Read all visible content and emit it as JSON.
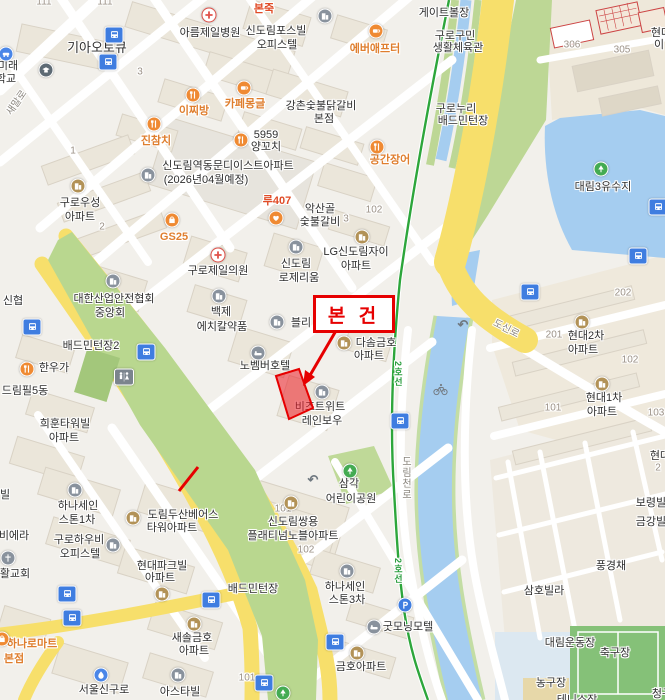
{
  "annotation": {
    "subject_label": "본 건",
    "box": {
      "x": 313,
      "y": 295,
      "w": 76,
      "h": 32,
      "font_size": 19
    },
    "arrow": {
      "x1": 337,
      "y1": 329,
      "x2": 307,
      "y2": 379
    },
    "extra_segment": {
      "x1": 198,
      "y1": 467,
      "x2": 179,
      "y2": 491
    },
    "building_polygon": "276,376 299,369 313,408 289,419",
    "color": "#e60000"
  },
  "colors": {
    "background": "#f2f0eb",
    "road_major_yellow": "#f7df6b",
    "road_white": "#ffffff",
    "water": "#a5cdf0",
    "green_park": "#b9d78f",
    "subway_line2_green": "#2da63b",
    "poi_food_orange": "#ef8a33",
    "poi_apartment_brown": "#b29257",
    "poi_gray": "#89929d",
    "bus_stop_blue": "#3f7de0",
    "annotation_red": "#e60000"
  },
  "map": {
    "labels": [
      {
        "t": "기아오토큐",
        "x": 97,
        "y": 48,
        "s": "place",
        "fs": 13
      },
      {
        "t": "미래",
        "x": 8,
        "y": 66,
        "s": "place"
      },
      {
        "t": "학교",
        "x": 6,
        "y": 79,
        "s": "place"
      },
      {
        "t": "아름제일병원",
        "x": 210,
        "y": 33,
        "s": "place"
      },
      {
        "t": "신도림포스빌",
        "x": 276,
        "y": 31,
        "s": "place"
      },
      {
        "t": "오피스텔",
        "x": 277,
        "y": 45,
        "s": "place"
      },
      {
        "t": "게이트볼장",
        "x": 444,
        "y": 13,
        "s": "place"
      },
      {
        "t": "구로구민",
        "x": 455,
        "y": 36,
        "s": "place"
      },
      {
        "t": "생활체육관",
        "x": 458,
        "y": 48,
        "s": "place"
      },
      {
        "t": "구로누리",
        "x": 456,
        "y": 109,
        "s": "place"
      },
      {
        "t": "배드민턴장",
        "x": 463,
        "y": 121,
        "s": "place"
      },
      {
        "t": "강촌숯불닭갈비",
        "x": 321,
        "y": 106,
        "s": "place"
      },
      {
        "t": "본점",
        "x": 324,
        "y": 119,
        "s": "place"
      },
      {
        "t": "5959",
        "x": 266,
        "y": 135,
        "s": "place"
      },
      {
        "t": "양꼬치",
        "x": 266,
        "y": 147,
        "s": "place"
      },
      {
        "t": "신도림역동문디이스트아파트",
        "x": 228,
        "y": 166,
        "s": "place"
      },
      {
        "t": "(2026년04월예정)",
        "x": 206,
        "y": 180,
        "s": "place"
      },
      {
        "t": "악산골",
        "x": 320,
        "y": 209,
        "s": "place"
      },
      {
        "t": "숯불갈비",
        "x": 320,
        "y": 222,
        "s": "place"
      },
      {
        "t": "구로우성",
        "x": 80,
        "y": 203,
        "s": "place"
      },
      {
        "t": "아파트",
        "x": 80,
        "y": 217,
        "s": "place"
      },
      {
        "t": "LG신도림자이",
        "x": 356,
        "y": 252,
        "s": "place"
      },
      {
        "t": "아파트",
        "x": 356,
        "y": 266,
        "s": "place"
      },
      {
        "t": "구로제일의원",
        "x": 218,
        "y": 271,
        "s": "place"
      },
      {
        "t": "신도림",
        "x": 296,
        "y": 264,
        "s": "place"
      },
      {
        "t": "로제리움",
        "x": 299,
        "y": 278,
        "s": "place"
      },
      {
        "t": "대한산업안전협회",
        "x": 114,
        "y": 299,
        "s": "place"
      },
      {
        "t": "중앙회",
        "x": 110,
        "y": 313,
        "s": "place"
      },
      {
        "t": "백제",
        "x": 221,
        "y": 312,
        "s": "place"
      },
      {
        "t": "에치칼약품",
        "x": 222,
        "y": 327,
        "s": "place"
      },
      {
        "t": "블리",
        "x": 301,
        "y": 323,
        "s": "place"
      },
      {
        "t": "다솜금호",
        "x": 376,
        "y": 343,
        "s": "place"
      },
      {
        "t": "아파트",
        "x": 369,
        "y": 356,
        "s": "place"
      },
      {
        "t": "배드민턴장2",
        "x": 91,
        "y": 346,
        "s": "place"
      },
      {
        "t": "한우가",
        "x": 54,
        "y": 368,
        "s": "place"
      },
      {
        "t": "드림필5동",
        "x": 25,
        "y": 391,
        "s": "place"
      },
      {
        "t": "신협",
        "x": 13,
        "y": 301,
        "s": "place"
      },
      {
        "t": "노벰버호텔",
        "x": 265,
        "y": 366,
        "s": "place"
      },
      {
        "t": "비즈트위트",
        "x": 320,
        "y": 407,
        "s": "place"
      },
      {
        "t": "레인보우",
        "x": 322,
        "y": 421,
        "s": "place"
      },
      {
        "t": "대림3유수지",
        "x": 603,
        "y": 187,
        "s": "place"
      },
      {
        "t": "현대2차",
        "x": 586,
        "y": 336,
        "s": "place"
      },
      {
        "t": "아파트",
        "x": 583,
        "y": 350,
        "s": "place"
      },
      {
        "t": "현대1차",
        "x": 604,
        "y": 398,
        "s": "place"
      },
      {
        "t": "아파트",
        "x": 602,
        "y": 412,
        "s": "place"
      },
      {
        "t": "삼각",
        "x": 349,
        "y": 484,
        "s": "place"
      },
      {
        "t": "어린이공원",
        "x": 351,
        "y": 499,
        "s": "place"
      },
      {
        "t": "신도림쌍용",
        "x": 293,
        "y": 522,
        "s": "place"
      },
      {
        "t": "플래티넘노블아파트",
        "x": 293,
        "y": 536,
        "s": "place"
      },
      {
        "t": "하나세인",
        "x": 78,
        "y": 506,
        "s": "place"
      },
      {
        "t": "스톤1차",
        "x": 77,
        "y": 520,
        "s": "place"
      },
      {
        "t": "희훈타워빌",
        "x": 65,
        "y": 424,
        "s": "place"
      },
      {
        "t": "아파트",
        "x": 64,
        "y": 438,
        "s": "place"
      },
      {
        "t": "구로하우비",
        "x": 79,
        "y": 540,
        "s": "place"
      },
      {
        "t": "오피스텔",
        "x": 80,
        "y": 554,
        "s": "place"
      },
      {
        "t": "도림두산베어스",
        "x": 183,
        "y": 515,
        "s": "place"
      },
      {
        "t": "타워아파트",
        "x": 172,
        "y": 528,
        "s": "place"
      },
      {
        "t": "현대파크빌",
        "x": 162,
        "y": 566,
        "s": "place"
      },
      {
        "t": "아파트",
        "x": 160,
        "y": 578,
        "s": "place"
      },
      {
        "t": "새솔금호",
        "x": 192,
        "y": 638,
        "s": "place"
      },
      {
        "t": "아파트",
        "x": 194,
        "y": 651,
        "s": "place"
      },
      {
        "t": "아스타빌",
        "x": 180,
        "y": 692,
        "s": "place"
      },
      {
        "t": "서울신구로",
        "x": 104,
        "y": 690,
        "s": "place"
      },
      {
        "t": "하나세인",
        "x": 345,
        "y": 587,
        "s": "place"
      },
      {
        "t": "스톤3차",
        "x": 347,
        "y": 600,
        "s": "place"
      },
      {
        "t": "굿모닝모텔",
        "x": 408,
        "y": 627,
        "s": "place"
      },
      {
        "t": "금호아파트",
        "x": 361,
        "y": 667,
        "s": "place"
      },
      {
        "t": "배드민턴장",
        "x": 253,
        "y": 589,
        "s": "place"
      },
      {
        "t": "대림운동장",
        "x": 570,
        "y": 643,
        "s": "place"
      },
      {
        "t": "축구장",
        "x": 615,
        "y": 653,
        "s": "place"
      },
      {
        "t": "농구장",
        "x": 551,
        "y": 683,
        "s": "place"
      },
      {
        "t": "삼호빌라",
        "x": 544,
        "y": 591,
        "s": "place"
      },
      {
        "t": "풍경채",
        "x": 611,
        "y": 566,
        "s": "place"
      },
      {
        "t": "보령빌라",
        "x": 656,
        "y": 503,
        "s": "place"
      },
      {
        "t": "금강빌라",
        "x": 656,
        "y": 522,
        "s": "place"
      },
      {
        "t": "현대",
        "x": 660,
        "y": 456,
        "s": "place"
      },
      {
        "t": "현대",
        "x": 661,
        "y": 33,
        "s": "place"
      },
      {
        "t": "이",
        "x": 659,
        "y": 45,
        "s": "place"
      },
      {
        "t": "테니스장",
        "x": 577,
        "y": 700,
        "s": "place"
      },
      {
        "t": "청구",
        "x": 662,
        "y": 694,
        "s": "place"
      },
      {
        "t": "활교회",
        "x": 15,
        "y": 574,
        "s": "place"
      },
      {
        "t": "비에라",
        "x": 14,
        "y": 536,
        "s": "place"
      },
      {
        "t": "빌",
        "x": 5,
        "y": 495,
        "s": "place"
      },
      {
        "t": "에버애프터",
        "x": 375,
        "y": 49,
        "s": "or"
      },
      {
        "t": "이찌방",
        "x": 194,
        "y": 111,
        "s": "or"
      },
      {
        "t": "카페몽글",
        "x": 245,
        "y": 104,
        "s": "or"
      },
      {
        "t": "진참치",
        "x": 156,
        "y": 141,
        "s": "or"
      },
      {
        "t": "공간장어",
        "x": 390,
        "y": 160,
        "s": "or"
      },
      {
        "t": "GS25",
        "x": 174,
        "y": 237,
        "s": "or"
      },
      {
        "t": "하나로마트",
        "x": 32,
        "y": 644,
        "s": "or"
      },
      {
        "t": "본점",
        "x": 14,
        "y": 659,
        "s": "or"
      },
      {
        "t": "본죽",
        "x": 264,
        "y": 9,
        "s": "br"
      },
      {
        "t": "루407",
        "x": 277,
        "y": 201,
        "s": "br"
      },
      {
        "t": "도신로",
        "x": 506,
        "y": 329,
        "s": "rd",
        "rot": 27
      },
      {
        "t": "새말로",
        "x": 17,
        "y": 103,
        "s": "rd",
        "rot": -55
      },
      {
        "t": "도림천로",
        "x": 405,
        "y": 478,
        "s": "rd",
        "vert": true
      },
      {
        "t": "2호선",
        "x": 397,
        "y": 571,
        "s": "gr",
        "vert": true
      },
      {
        "t": "2호선",
        "x": 397,
        "y": 374,
        "s": "gr",
        "vert": true
      },
      {
        "t": "3",
        "x": 140,
        "y": 72,
        "s": "nm"
      },
      {
        "t": "1",
        "x": 73,
        "y": 151,
        "s": "nm"
      },
      {
        "t": "2",
        "x": 102,
        "y": 227,
        "s": "nm"
      },
      {
        "t": "3",
        "x": 346,
        "y": 219,
        "s": "nm"
      },
      {
        "t": "102",
        "x": 374,
        "y": 210,
        "s": "nm"
      },
      {
        "t": "202",
        "x": 623,
        "y": 293,
        "s": "nm"
      },
      {
        "t": "201",
        "x": 554,
        "y": 335,
        "s": "nm"
      },
      {
        "t": "102",
        "x": 630,
        "y": 360,
        "s": "nm"
      },
      {
        "t": "101",
        "x": 553,
        "y": 408,
        "s": "nm"
      },
      {
        "t": "103",
        "x": 656,
        "y": 413,
        "s": "nm"
      },
      {
        "t": "306",
        "x": 572,
        "y": 45,
        "s": "nm"
      },
      {
        "t": "305",
        "x": 622,
        "y": 50,
        "s": "nm"
      },
      {
        "t": "102",
        "x": 306,
        "y": 550,
        "s": "nm"
      },
      {
        "t": "101",
        "x": 283,
        "y": 509,
        "s": "nm"
      },
      {
        "t": "101",
        "x": 247,
        "y": 678,
        "s": "nm"
      },
      {
        "t": "111",
        "x": 44,
        "y": 2,
        "s": "nm"
      },
      {
        "t": "111",
        "x": 105,
        "y": 2,
        "s": "nm"
      },
      {
        "t": "2",
        "x": 658,
        "y": 468,
        "s": "nm"
      }
    ],
    "pois": [
      {
        "k": "hospital",
        "x": 209,
        "y": 15
      },
      {
        "k": "hospital",
        "x": 218,
        "y": 255
      },
      {
        "k": "company",
        "x": 325,
        "y": 16
      },
      {
        "k": "company",
        "x": 148,
        "y": 175
      },
      {
        "k": "company",
        "x": 296,
        "y": 247
      },
      {
        "k": "company",
        "x": 277,
        "y": 322
      },
      {
        "k": "company",
        "x": 219,
        "y": 296
      },
      {
        "k": "company",
        "x": 113,
        "y": 281
      },
      {
        "k": "company",
        "x": 75,
        "y": 490
      },
      {
        "k": "company",
        "x": 347,
        "y": 571
      },
      {
        "k": "company",
        "x": 113,
        "y": 545
      },
      {
        "k": "company",
        "x": 178,
        "y": 675
      },
      {
        "k": "company",
        "x": 322,
        "y": 392
      },
      {
        "k": "hotel",
        "x": 258,
        "y": 353
      },
      {
        "k": "hotel",
        "x": 374,
        "y": 627
      },
      {
        "k": "church",
        "x": 8,
        "y": 558
      },
      {
        "k": "school",
        "x": 46,
        "y": 70
      },
      {
        "k": "apartment",
        "x": 78,
        "y": 186
      },
      {
        "k": "apartment",
        "x": 362,
        "y": 237
      },
      {
        "k": "apartment",
        "x": 344,
        "y": 343
      },
      {
        "k": "apartment",
        "x": 582,
        "y": 322
      },
      {
        "k": "apartment",
        "x": 602,
        "y": 384
      },
      {
        "k": "apartment",
        "x": 291,
        "y": 503
      },
      {
        "k": "apartment",
        "x": 133,
        "y": 518
      },
      {
        "k": "apartment",
        "x": 162,
        "y": 594
      },
      {
        "k": "apartment",
        "x": 194,
        "y": 624
      },
      {
        "k": "apartment",
        "x": 357,
        "y": 653
      },
      {
        "k": "cafe",
        "x": 376,
        "y": 31
      },
      {
        "k": "food",
        "x": 193,
        "y": 95
      },
      {
        "k": "cafe",
        "x": 244,
        "y": 88
      },
      {
        "k": "food",
        "x": 154,
        "y": 124
      },
      {
        "k": "food",
        "x": 241,
        "y": 140
      },
      {
        "k": "food",
        "x": 377,
        "y": 147
      },
      {
        "k": "food",
        "x": 27,
        "y": 369
      },
      {
        "k": "store",
        "x": 2,
        "y": 639
      },
      {
        "k": "store",
        "x": 172,
        "y": 220
      },
      {
        "k": "heart",
        "x": 276,
        "y": 218
      },
      {
        "k": "park",
        "x": 350,
        "y": 471
      },
      {
        "k": "park",
        "x": 601,
        "y": 169
      },
      {
        "k": "park",
        "x": 283,
        "y": 693
      },
      {
        "k": "fire",
        "x": 101,
        "y": 675
      },
      {
        "k": "car",
        "x": 6,
        "y": 54
      },
      {
        "k": "parking",
        "x": 405,
        "y": 605
      },
      {
        "k": "restroom",
        "x": 124,
        "y": 377
      },
      {
        "k": "bike",
        "x": 440,
        "y": 389
      },
      {
        "k": "uturn",
        "x": 463,
        "y": 325
      },
      {
        "k": "uturn",
        "x": 313,
        "y": 480
      }
    ],
    "bus_stops": [
      [
        114,
        35
      ],
      [
        108,
        62
      ],
      [
        32,
        327
      ],
      [
        146,
        352
      ],
      [
        530,
        292
      ],
      [
        658,
        207
      ],
      [
        638,
        256
      ],
      [
        67,
        594
      ],
      [
        72,
        618
      ],
      [
        211,
        600
      ],
      [
        335,
        642
      ],
      [
        264,
        683
      ],
      [
        400,
        421
      ]
    ]
  }
}
